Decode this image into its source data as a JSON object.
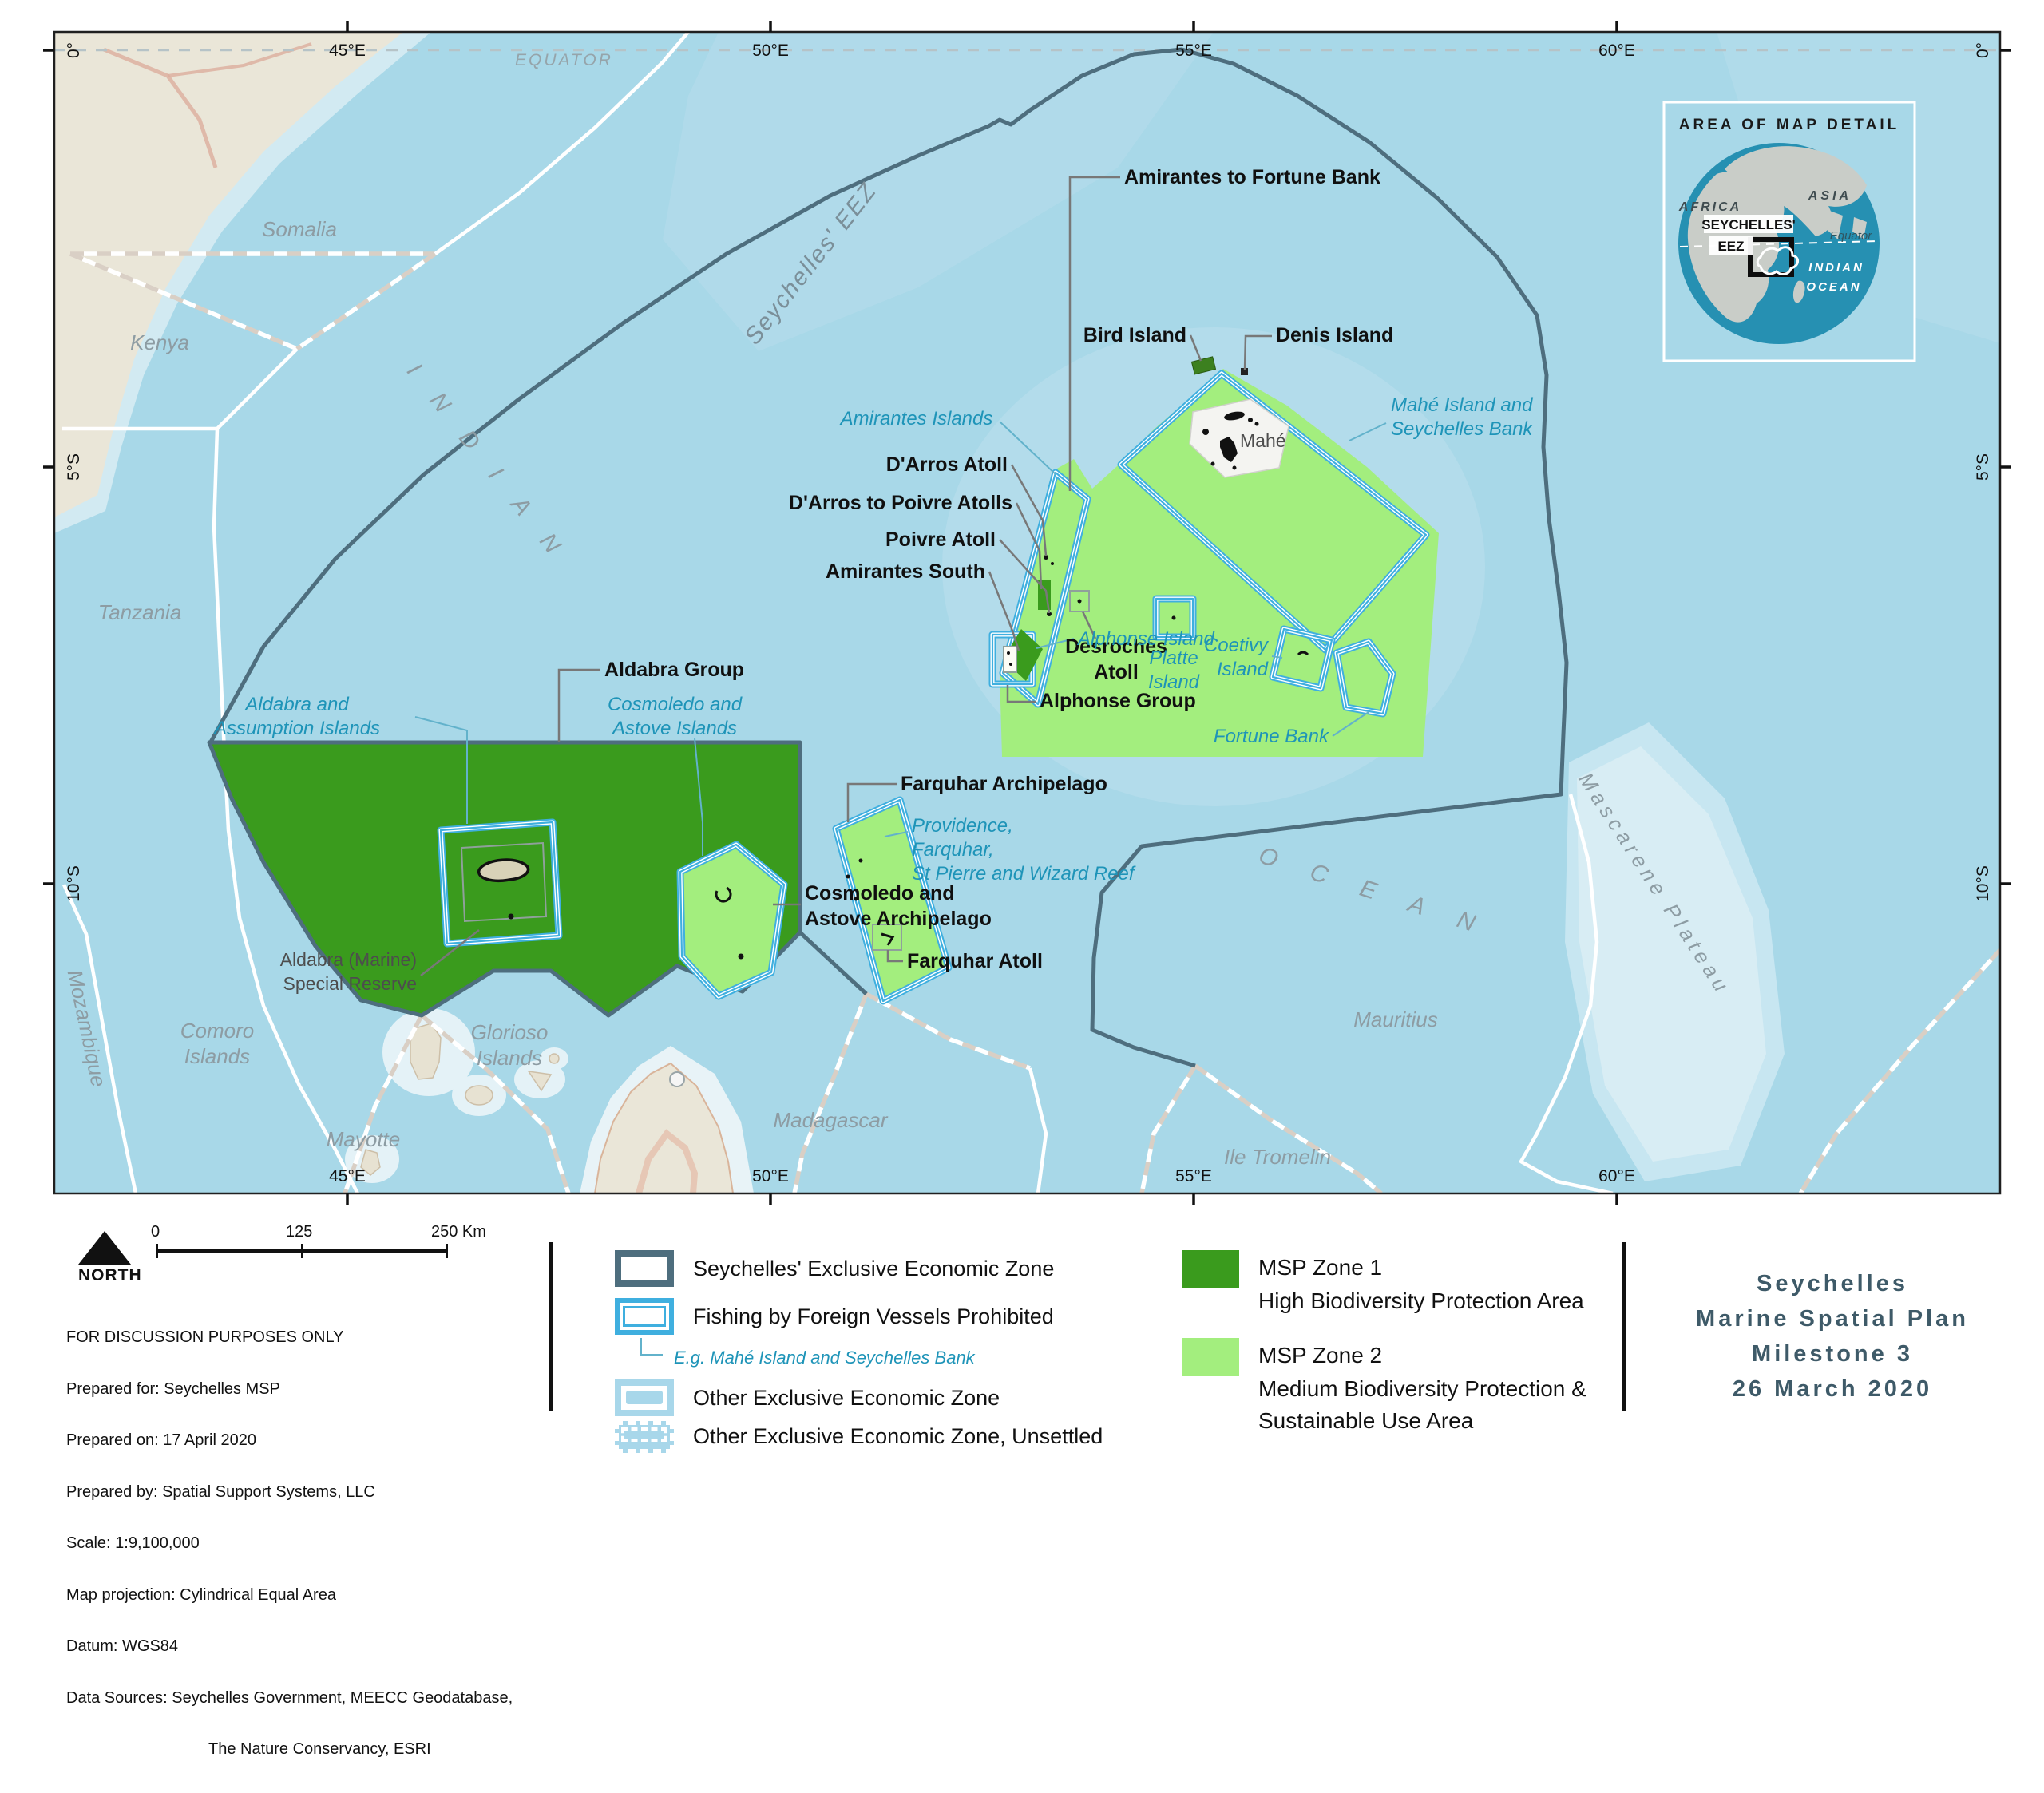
{
  "colors": {
    "zone1": "#3a9b1d",
    "zone2": "#a3ee7e",
    "eez": "#4e6e7e",
    "prohibited": "#3fafdf",
    "ocean": "#a8d8e8"
  },
  "map": {
    "equator": "EQUATOR",
    "eez_label": "Seychelles' EEZ",
    "lon_ticks": [
      "45°E",
      "50°E",
      "55°E",
      "60°E"
    ],
    "lat_ticks": [
      "0°",
      "5°S",
      "10°S"
    ],
    "countries": {
      "somalia": "Somalia",
      "kenya": "Kenya",
      "tanzania": "Tanzania",
      "mozambique": "Mozambique",
      "madagascar": "Madagascar",
      "mauritius": "Mauritius",
      "ile_tromelin": "Ile Tromelin",
      "mayotte": "Mayotte",
      "comoro": [
        "Comoro",
        "Islands"
      ],
      "glorioso": [
        "Glorioso",
        "Islands"
      ]
    },
    "ocean_labels": {
      "indian": "INDIAN",
      "ocean": "OCEAN",
      "mascarene": "Mascarene Plateau"
    },
    "features": {
      "amirantes_fortune": "Amirantes to Fortune Bank",
      "bird": "Bird Island",
      "denis": "Denis Island",
      "darros": "D'Arros Atoll",
      "darros_poivre": "D'Arros to Poivre Atolls",
      "poivre": "Poivre Atoll",
      "amirantes_south": "Amirantes South",
      "desroches": [
        "Desroches",
        "Atoll"
      ],
      "mahe": "Mahé",
      "alphonse_group": "Alphonse Group",
      "aldabra_group": "Aldabra Group",
      "cosmoledo_arch": [
        "Cosmoledo and",
        "Astove Archipelago"
      ],
      "farquhar_arch": "Farquhar Archipelago",
      "farquhar_atoll": "Farquhar Atoll",
      "aldabra_reserve": [
        "Aldabra (Marine)",
        "Special Reserve"
      ]
    },
    "blue_labels": {
      "amirantes_islands": "Amirantes Islands",
      "mahe_bank": [
        "Mahé Island and",
        "Seychelles Bank"
      ],
      "platte": [
        "Platte",
        "Island"
      ],
      "alphonse_island": "Alphonse Island",
      "coetivy": [
        "Coetivy",
        "Island"
      ],
      "fortune_bank": "Fortune Bank",
      "aldabra_assumption": [
        "Aldabra and",
        "Assumption Islands"
      ],
      "cosmoledo_islands": [
        "Cosmoledo and",
        "Astove Islands"
      ],
      "providence": [
        "Providence,",
        "Farquhar,",
        "St Pierre and Wizard Reef"
      ]
    }
  },
  "inset": {
    "title": "AREA OF MAP DETAIL",
    "asia": "ASIA",
    "africa": "AFRICA",
    "seychelles": "SEYCHELLES'",
    "eez": "EEZ",
    "equator": "Equator",
    "indian": "INDIAN",
    "ocean": "OCEAN"
  },
  "footer": {
    "north": "NORTH",
    "scale_0": "0",
    "scale_125": "125",
    "scale_250": "250 Km",
    "lines": [
      "FOR DISCUSSION PURPOSES ONLY",
      "Prepared for: Seychelles MSP",
      "Prepared on: 17 April 2020",
      "Prepared by: Spatial Support Systems, LLC",
      "Scale: 1:9,100,000",
      "Map projection: Cylindrical Equal Area",
      "Datum: WGS84",
      "Data Sources: Seychelles Government, MEECC Geodatabase,",
      "The Nature Conservancy, ESRI"
    ]
  },
  "legend": {
    "eez": "Seychelles' Exclusive Economic Zone",
    "fishing": "Fishing by Foreign Vessels Prohibited",
    "fishing_eg": "E.g. Mahé Island and Seychelles Bank",
    "other_eez": "Other Exclusive Economic Zone",
    "other_eez_unsettled": "Other Exclusive Economic Zone, Unsettled",
    "zone1": "MSP Zone 1",
    "zone1_desc": "High Biodiversity Protection Area",
    "zone2": "MSP Zone 2",
    "zone2_desc1": "Medium Biodiversity Protection &",
    "zone2_desc2": "Sustainable Use Area"
  },
  "title_block": {
    "lines": [
      "Seychelles",
      "Marine Spatial Plan",
      "Milestone 3",
      "26 March 2020"
    ]
  }
}
